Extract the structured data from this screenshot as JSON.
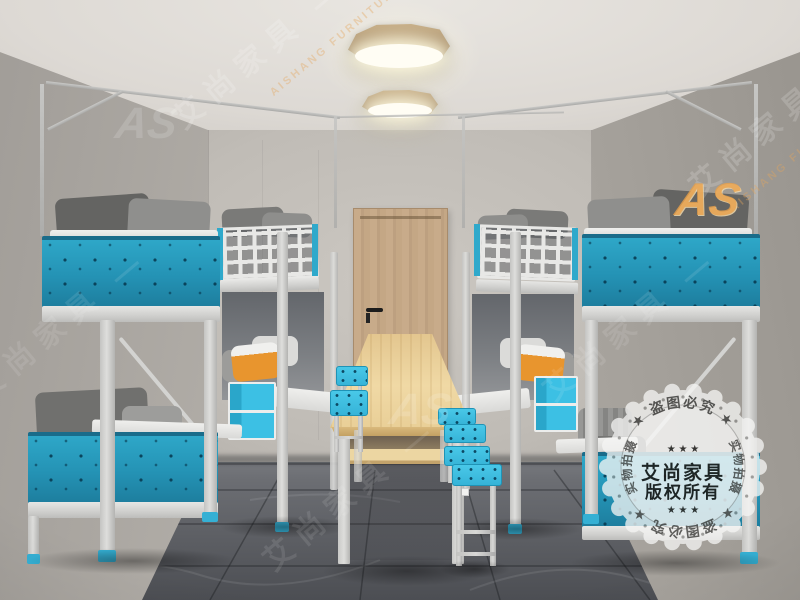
{
  "watermark": {
    "diagonal_cn": "艾尚家具 —",
    "diagonal_en": "AISHANG FURNITURE",
    "logo": "AS"
  },
  "stamp": {
    "brand": "艾尚家具",
    "copyright": "版权所有",
    "arc_top": "★ 盗图必究 ★",
    "arc_bottom": "★ 盗图必究 ★",
    "arc_left": "实物拍摄",
    "arc_right": "实物拍摄",
    "stars": "★ ★ ★"
  },
  "colors": {
    "teal_panel": "#2492b4",
    "accent_blue": "#3cc0e4",
    "door_wood": "#c3a687",
    "table_wood": "#ecd49e",
    "light_wood_rim": "#a78f6d",
    "wall": "#b6b2ac",
    "ceiling": "#ddd9d4",
    "floor": "#63656b",
    "frame_white": "#d9d9d7",
    "pillow_gray": "#6e6e6c",
    "pillow_orange": "#e8952e",
    "logo_orange": "#e9a04a"
  }
}
